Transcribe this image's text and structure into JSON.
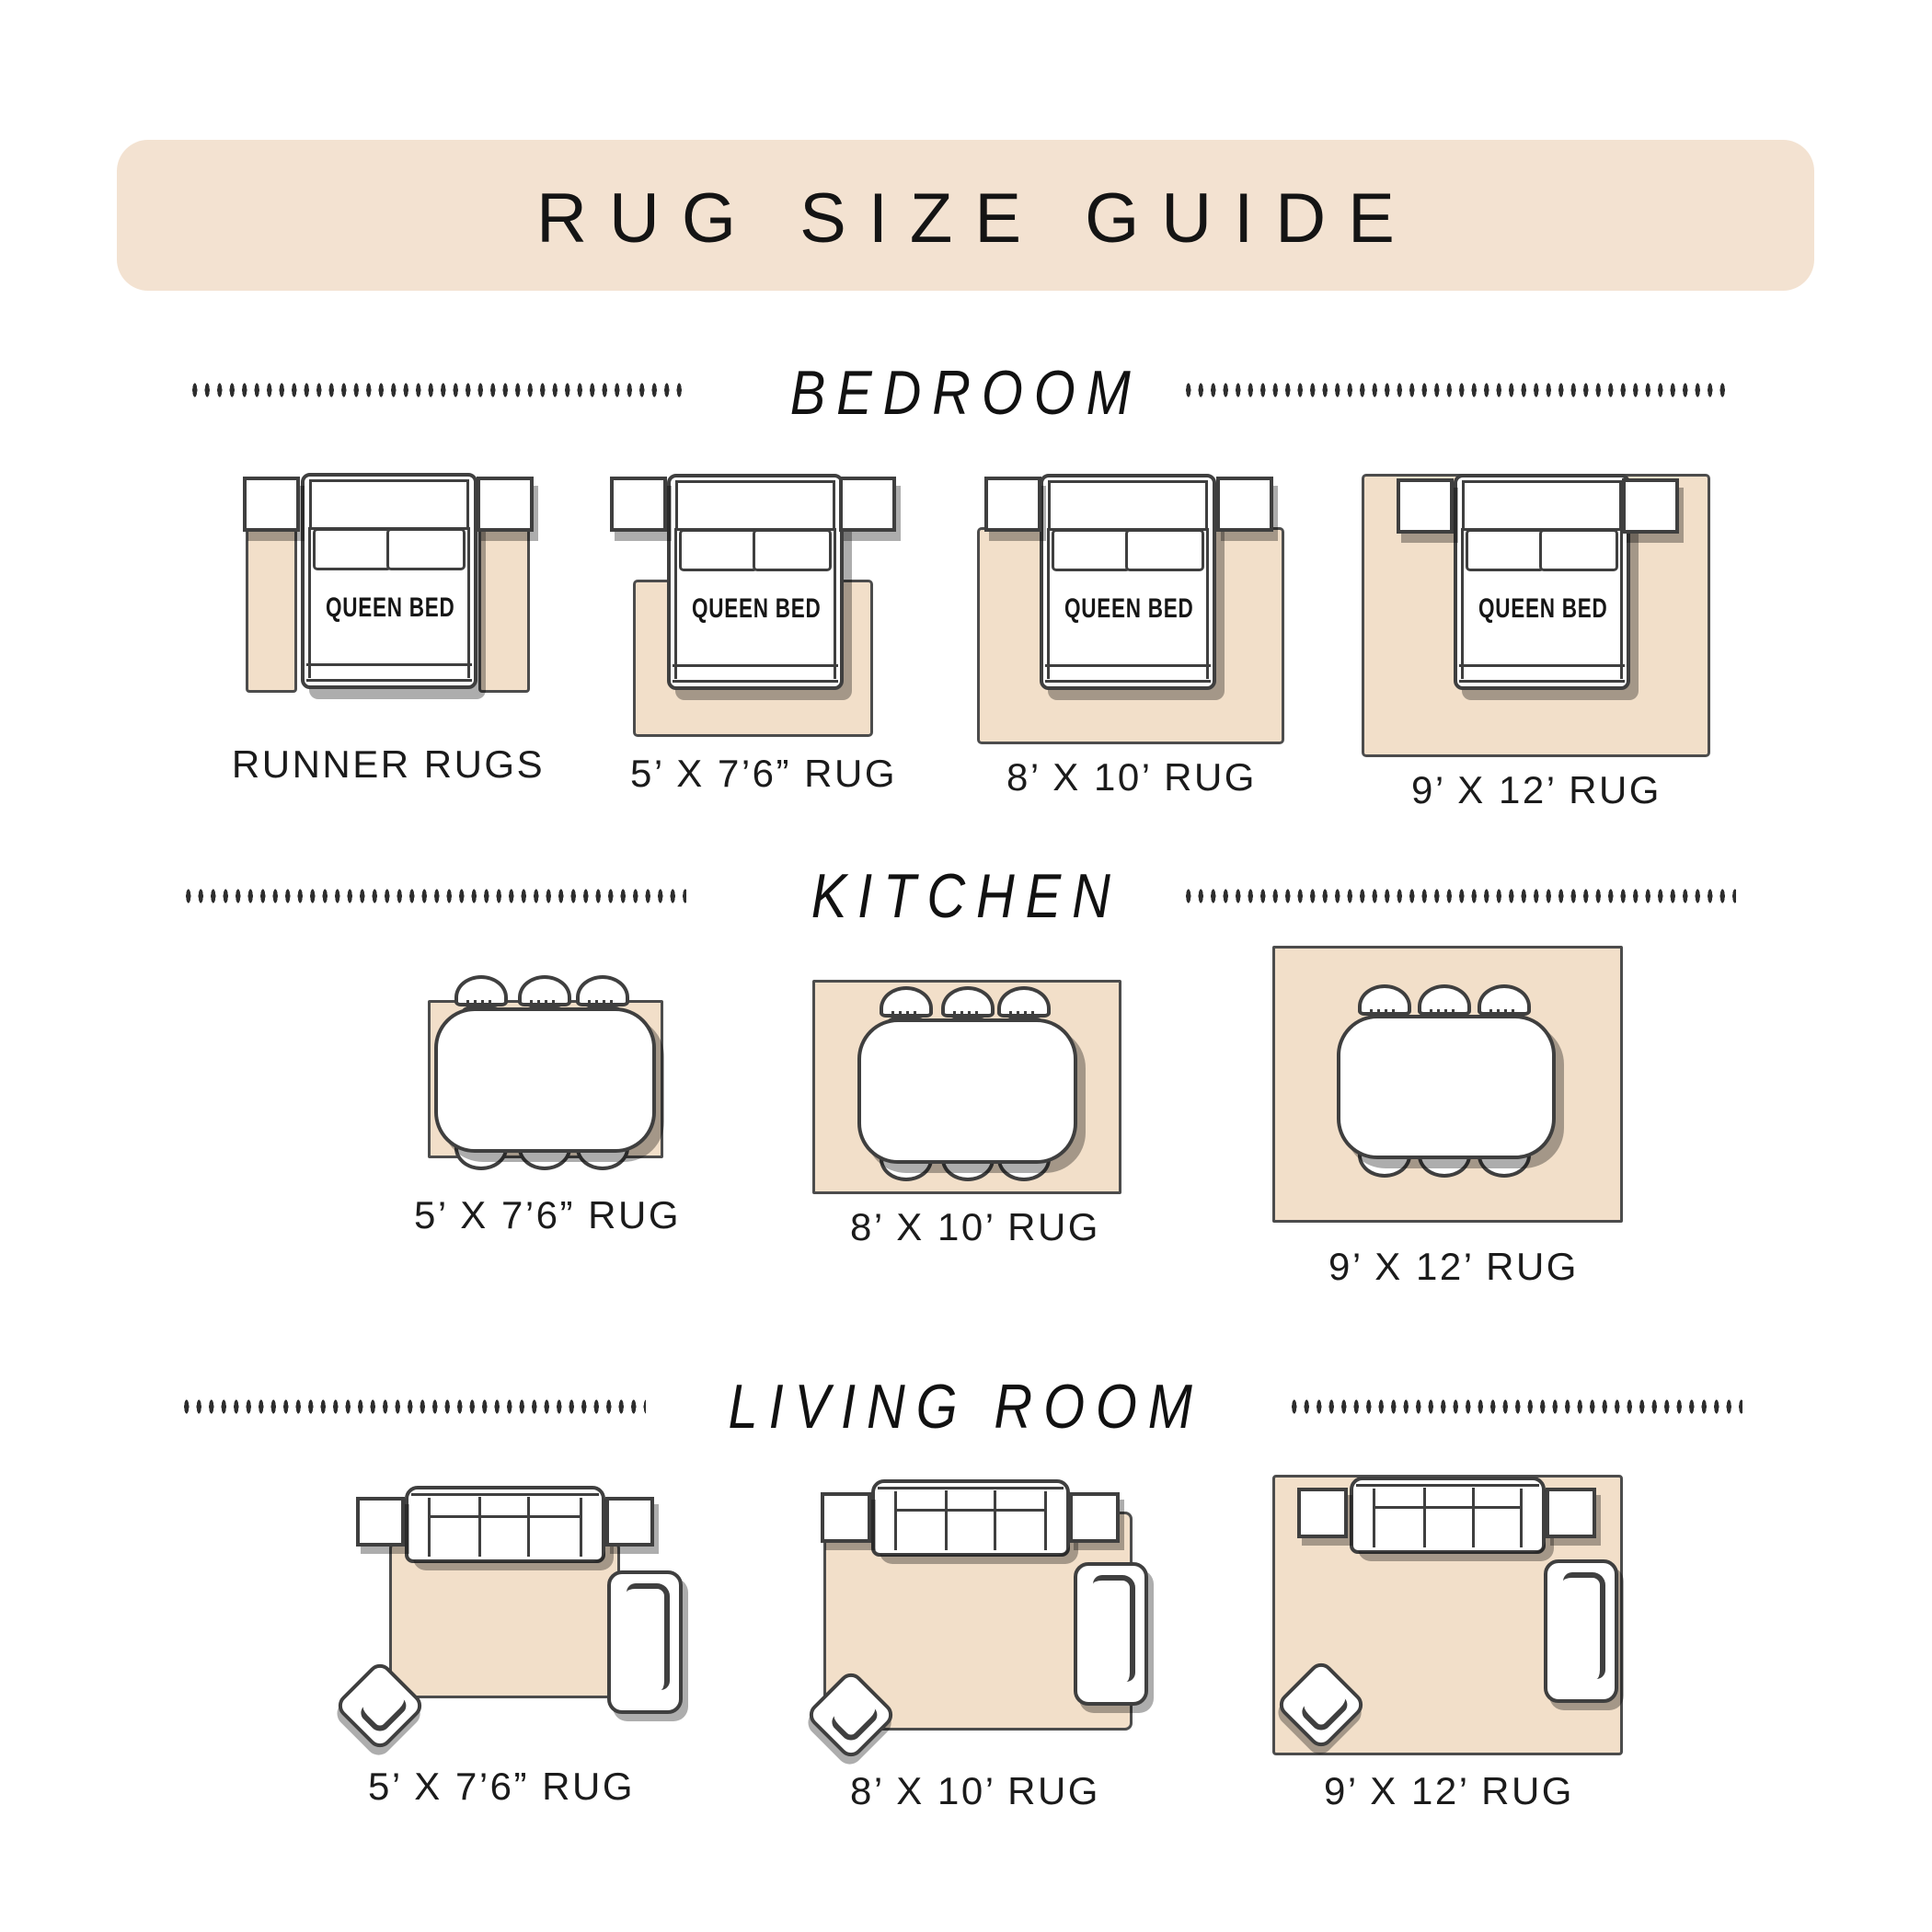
{
  "title": "RUG SIZE GUIDE",
  "bed_label": "QUEEN BED",
  "sections": [
    {
      "label": "BEDROOM",
      "items": [
        {
          "label": "RUNNER RUGS"
        },
        {
          "label": "5’ X 7’6” RUG"
        },
        {
          "label": "8’ X 10’ RUG"
        },
        {
          "label": "9’ X 12’ RUG"
        }
      ]
    },
    {
      "label": "KITCHEN",
      "items": [
        {
          "label": "5’ X 7’6” RUG"
        },
        {
          "label": "8’ X 10’ RUG"
        },
        {
          "label": "9’ X 12’ RUG"
        }
      ]
    },
    {
      "label": "LIVING ROOM",
      "items": [
        {
          "label": "5’ X 7’6” RUG"
        },
        {
          "label": "8’ X 10’ RUG"
        },
        {
          "label": "9’ X 12’ RUG"
        }
      ]
    }
  ],
  "colors": {
    "banner": "#f3e2d1",
    "rug": "#f2dfc9",
    "line": "#3f3f3f",
    "shadow": "rgba(0,0,0,0.32)",
    "text": "#1b1b1b"
  }
}
